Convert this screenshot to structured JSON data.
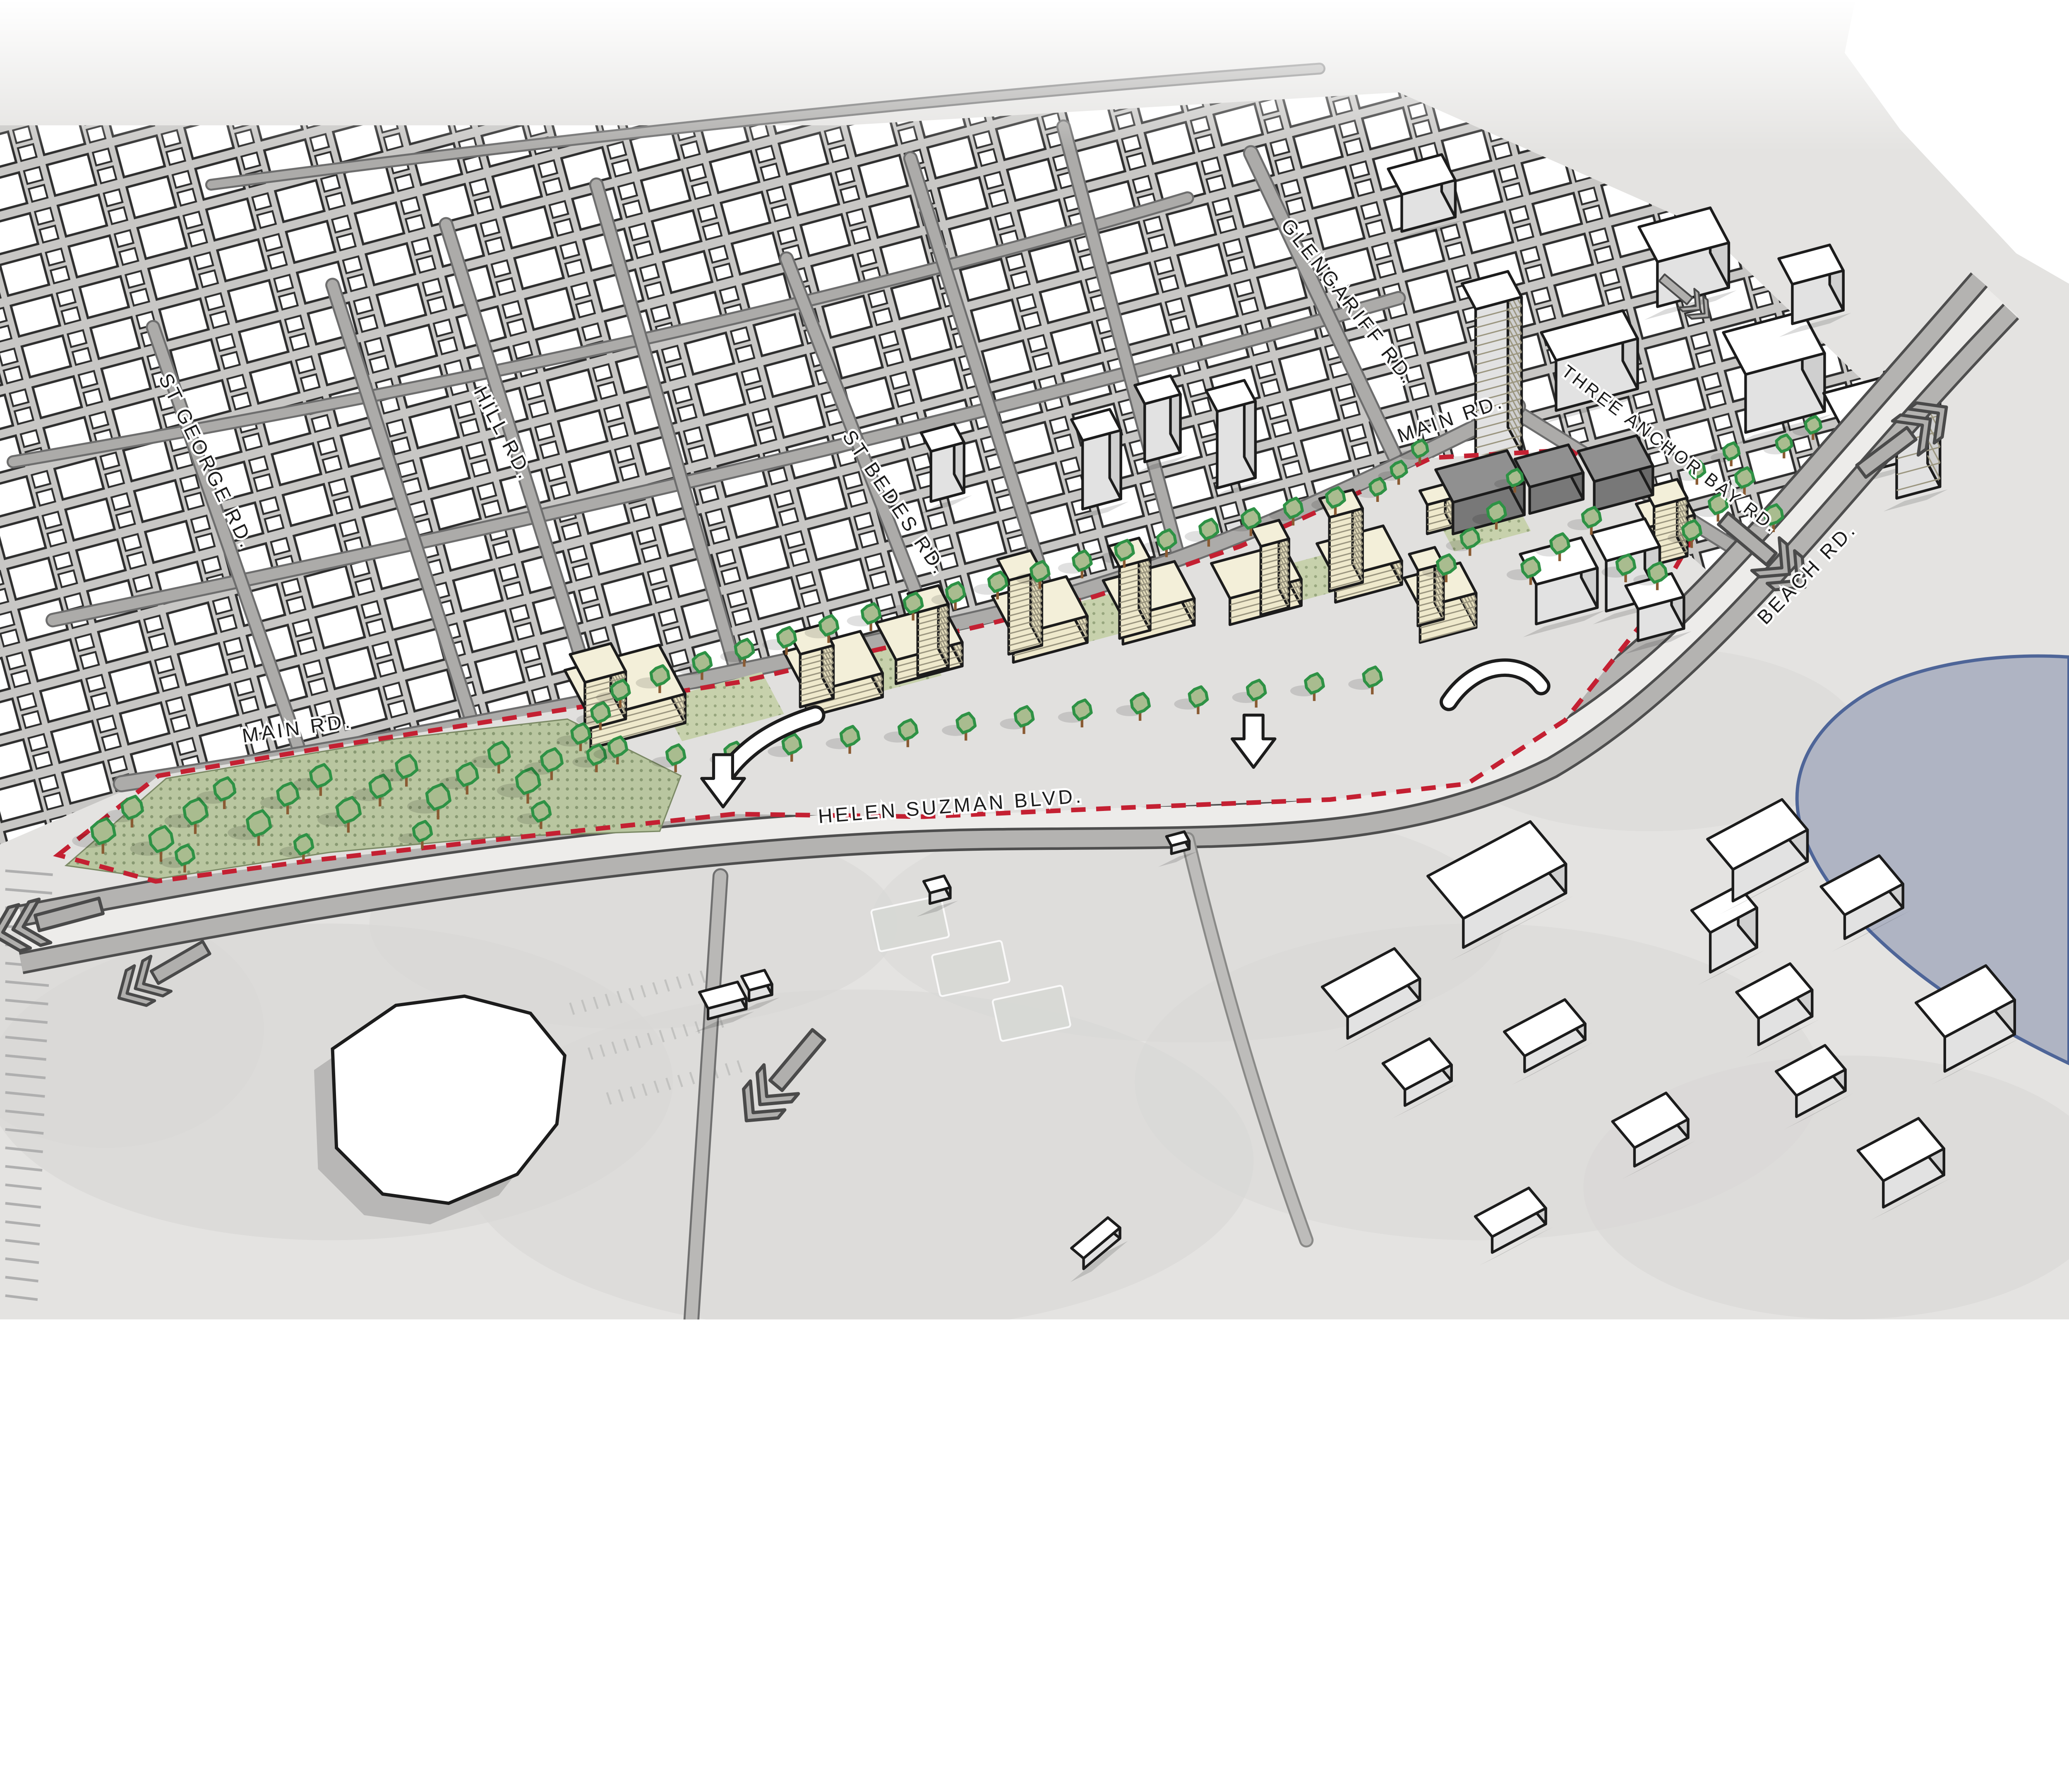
{
  "map": {
    "street_labels": [
      {
        "id": "st-george-rd",
        "text": "ST GEORGE RD."
      },
      {
        "id": "hill-rd",
        "text": "HILL RD."
      },
      {
        "id": "st-bedes-rd",
        "text": "ST BEDES RD."
      },
      {
        "id": "glengariff-rd",
        "text": "GLENGARIFF RD."
      },
      {
        "id": "main-rd-upper",
        "text": "MAIN RD."
      },
      {
        "id": "three-anchor-bay-rd",
        "text": "THREE ANCHOR BAY RD."
      },
      {
        "id": "beach-rd",
        "text": "BEACH RD."
      },
      {
        "id": "main-rd-lower",
        "text": "MAIN RD."
      },
      {
        "id": "helen-suzman-blvd",
        "text": "HELEN SUZMAN BLVD."
      }
    ],
    "icons": {
      "traffic_flow": "double-chevron-arrow",
      "site_entry": "outline-down-arrow"
    },
    "colors": {
      "background": "#FFFFFF",
      "ground": "#E4E3E1",
      "site_ground": "#E1E0DE",
      "water_fill": "#AFB4C3",
      "water_edge": "#4E6598",
      "road_fill": "#B4B3B1",
      "road_casing": "#4E4E4E",
      "road_median": "#EDECEA",
      "street_fill": "#ACABA9",
      "street_casing": "#6E6E6E",
      "fabric_gap": "#C8C7C5",
      "existing_building": "#FFFFFF",
      "existing_face": "#E2E2E2",
      "existing_side": "#CFCFCF",
      "building_outline": "#1C1C1C",
      "proposed_roof": "#F3EFD9",
      "proposed_face": "#EFE9CC",
      "proposed_side": "#E6DFBE",
      "floor_line": "#9B9680",
      "dark_roof": "#909090",
      "dark_face": "#787878",
      "dark_side": "#696969",
      "tree_fill": "#A9BC8F",
      "tree_edge": "#2E9245",
      "tree_trunk": "#8A5B33",
      "park_fill": "#B9C6A0",
      "park_dot": "#889972",
      "courtyard_fill": "#C7D1AC",
      "courtyard_dot": "#97A67E",
      "site_boundary": "#C42032",
      "arrow_gray": "#B0AFAD",
      "arrow_dark": "#4A4A4A",
      "white_arrow": "#FFFFFF",
      "label_color": "#1C1C1C",
      "label_halo": "#FFFFFF"
    }
  }
}
